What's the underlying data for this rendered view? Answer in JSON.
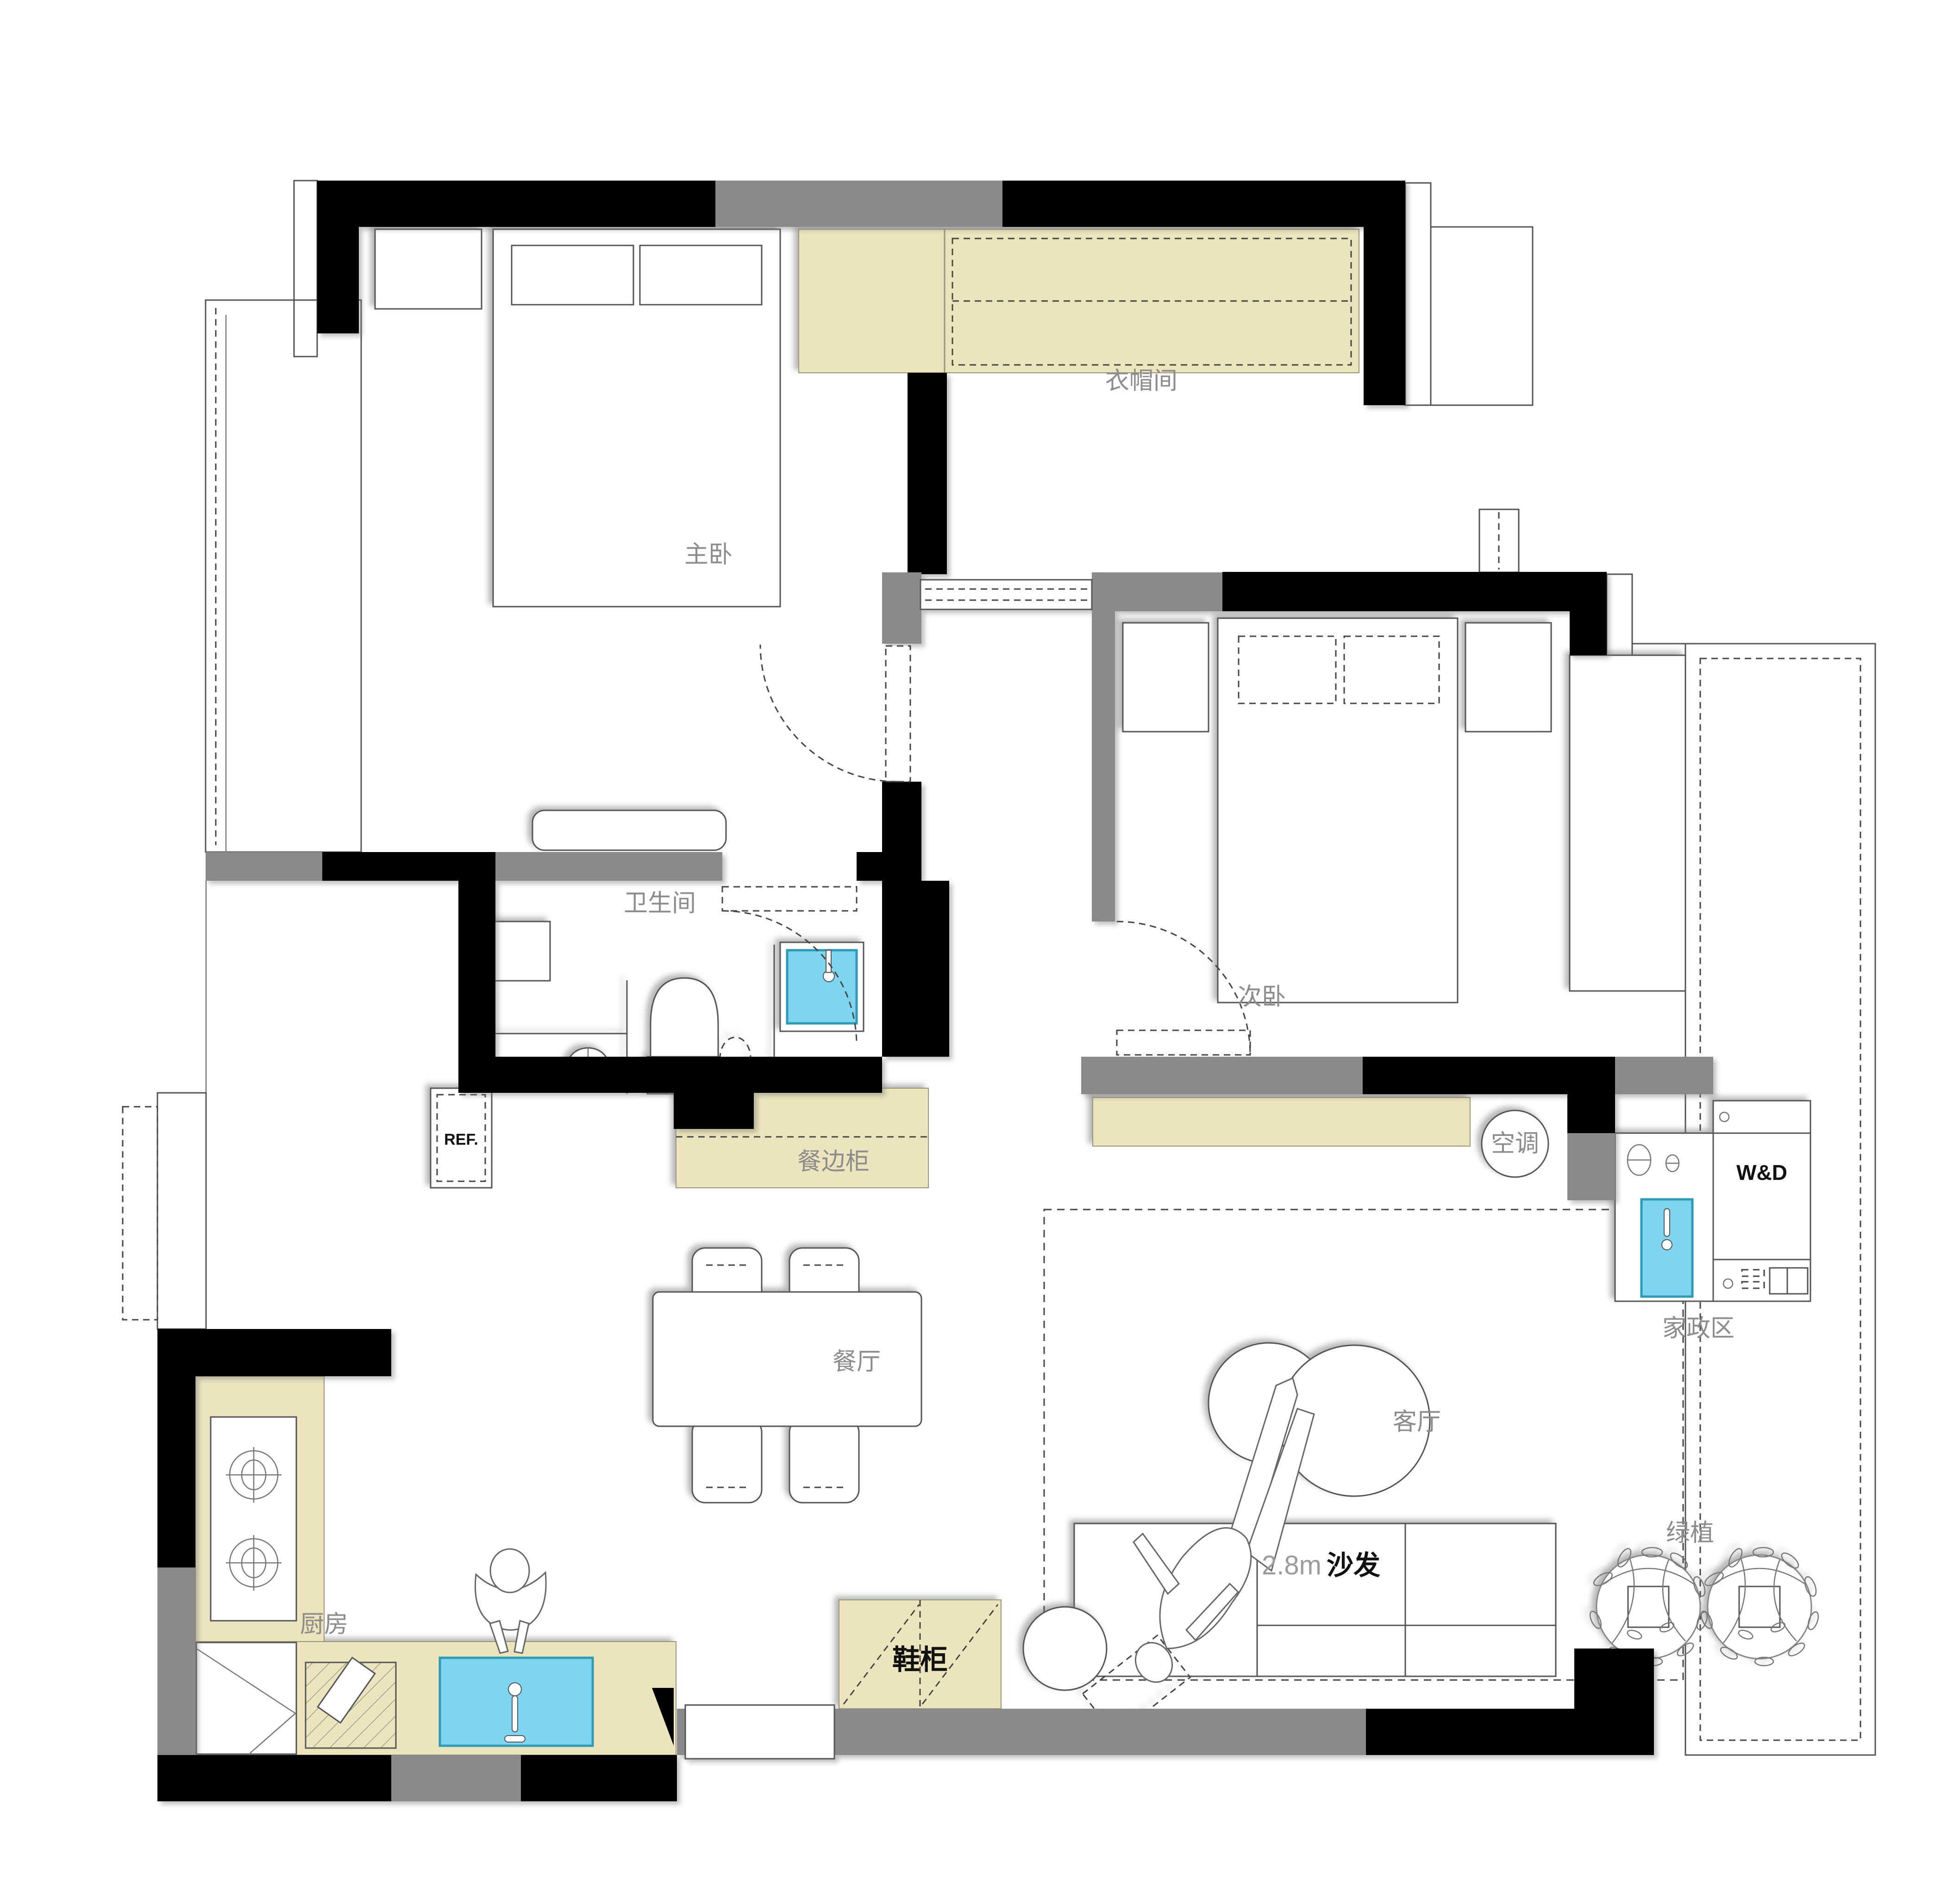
{
  "labels": {
    "master_bedroom": "主卧",
    "walkin_closet": "衣帽间",
    "bathroom": "卫生间",
    "second_bedroom": "次卧",
    "sideboard": "餐边柜",
    "air_conditioner": "空调",
    "washer_dryer": "W&D",
    "laundry_area": "家政区",
    "dining_room": "餐厅",
    "living_room": "客厅",
    "kitchen": "厨房",
    "shoe_cabinet": "鞋柜",
    "sofa_size": "2.8m",
    "sofa": "沙发",
    "plants": "绿植",
    "fridge": "REF."
  },
  "colors": {
    "structural_wall": "#000000",
    "partition_wall": "#8a8a8a",
    "cabinet_fill": "#ece4bc",
    "water_fill": "#7fd4ef",
    "label_gray": "#8c8c8c"
  }
}
